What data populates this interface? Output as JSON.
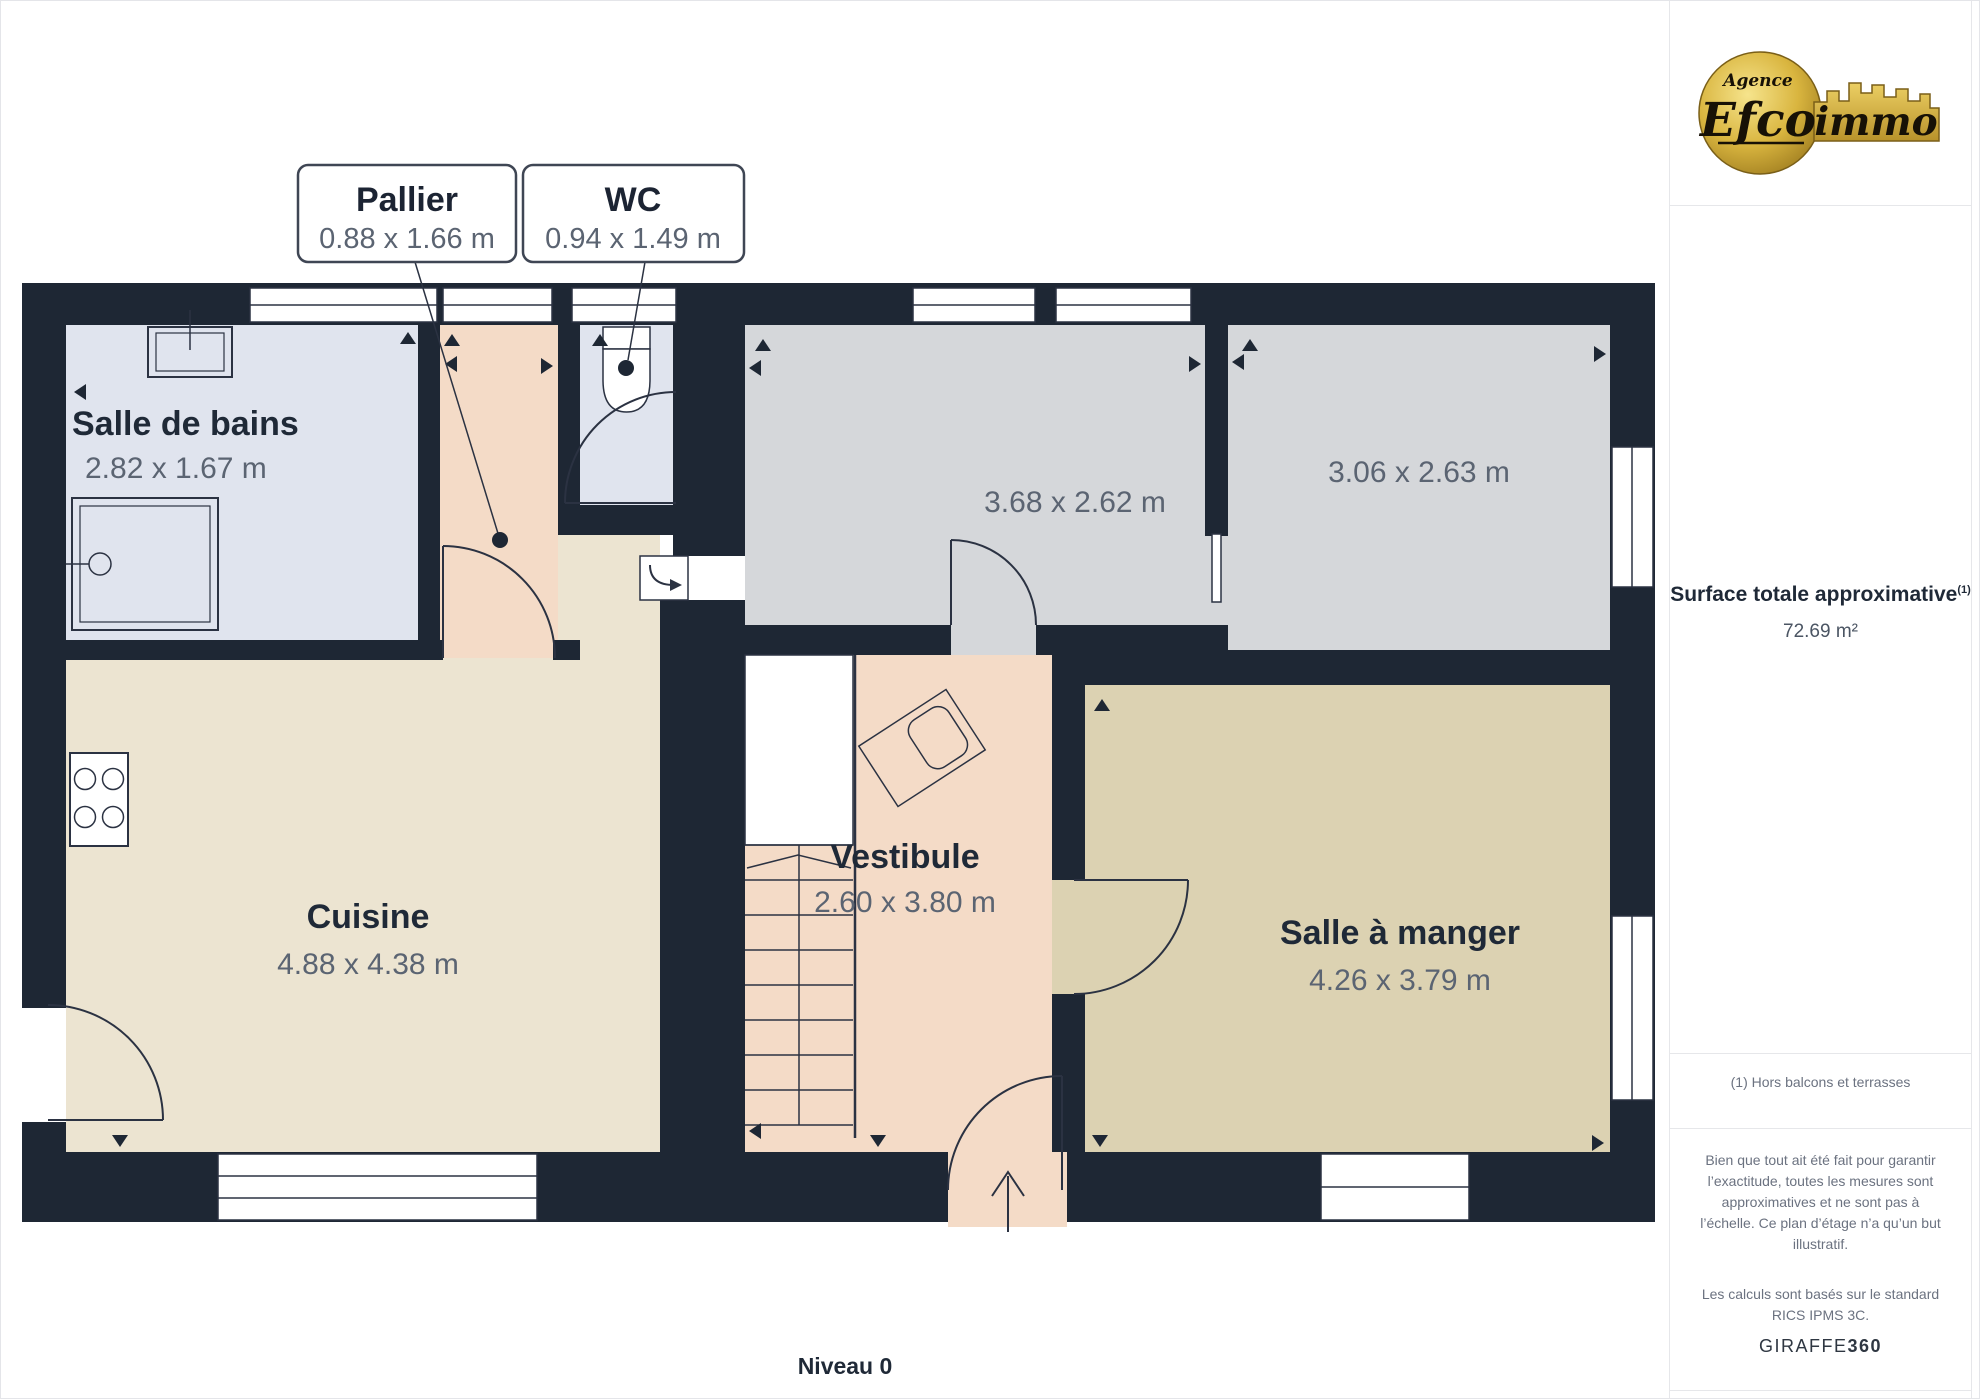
{
  "page": {
    "level_label": "Niveau 0"
  },
  "logo": {
    "line1": "Agence",
    "line2": "Efco",
    "line3": "immo"
  },
  "sidebar": {
    "surface_title": "Surface totale approximative",
    "surface_sup": "(1)",
    "surface_value": "72.69 m²",
    "note": "(1) Hors balcons et terrasses",
    "disclaimer": "Bien que tout ait été fait pour garantir l’exactitude, toutes les mesures sont approximatives et ne sont pas à l’échelle. Ce plan d’étage n’a qu’un but illustratif.",
    "standard": "Les calculs sont basés sur le standard RICS IPMS 3C.",
    "brand": "GIRAFFE",
    "brand_suffix": "360"
  },
  "callouts": [
    {
      "name": "Pallier",
      "dims": "0.88 x 1.66 m"
    },
    {
      "name": "WC",
      "dims": "0.94 x 1.49 m"
    }
  ],
  "rooms": [
    {
      "name": "Salle de bains",
      "dims": "2.82 x 1.67 m"
    },
    {
      "name": "Cuisine",
      "dims": "4.88 x 4.38 m"
    },
    {
      "name": "Vestibule",
      "dims": "2.60 x 3.80 m"
    },
    {
      "name": "Salle à manger",
      "dims": "4.26 x 3.79 m"
    },
    {
      "name": "",
      "dims": "3.68 x 2.62 m"
    },
    {
      "name": "",
      "dims": "3.06 x 2.63 m"
    }
  ],
  "colors": {
    "wall": "#1e2734",
    "floor_bath": "#e0e4ee",
    "floor_hall": "#f4dbc7",
    "floor_gray": "#d5d7da",
    "floor_kitchen": "#ece4d1",
    "floor_dining": "#dcd2b2",
    "title_text": "#1f2937",
    "dim_text": "#5b6472",
    "logo_gold": "#d4af37"
  }
}
